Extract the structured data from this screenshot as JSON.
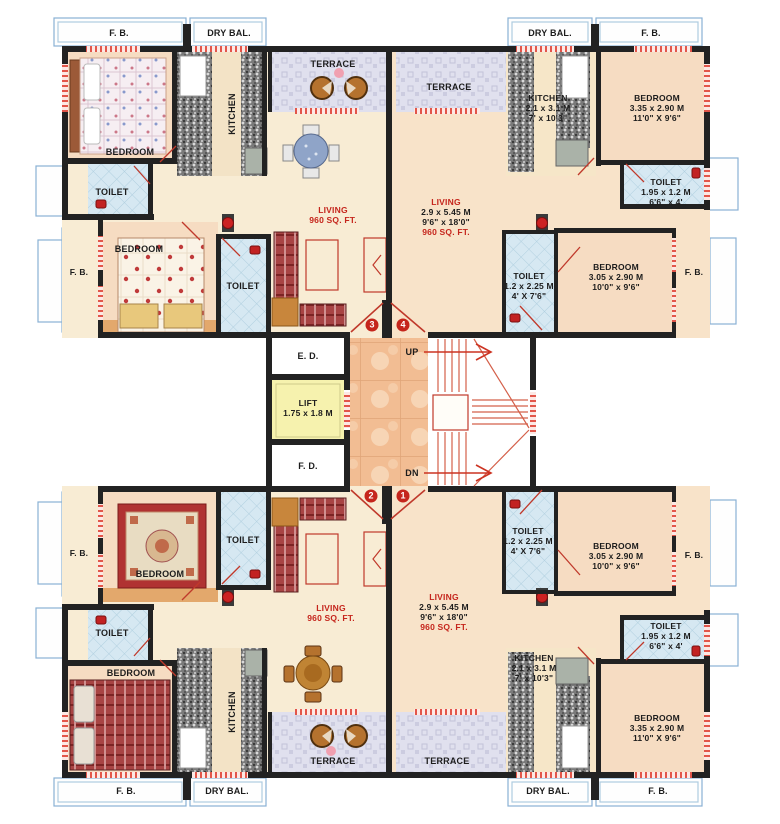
{
  "core": {
    "ed": "E. D.",
    "lift": "LIFT",
    "lift_dim": "1.75 x 1.8 M",
    "fd": "F. D.",
    "up": "UP",
    "dn": "DN"
  },
  "flats": {
    "top_left": {
      "number": "3",
      "fb_top": "F. B.",
      "dry_bal": "DRY BAL.",
      "terrace": "TERRACE",
      "kitchen": "KITCHEN",
      "bedroom1": "BEDROOM",
      "toilet1": "TOILET",
      "bedroom2": "BEDROOM",
      "fb_left": "F. B.",
      "toilet2": "TOILET",
      "living": "LIVING",
      "living_area": "960 SQ. FT."
    },
    "top_right": {
      "number": "4",
      "dry_bal": "DRY BAL.",
      "fb_top": "F. B.",
      "terrace": "TERRACE",
      "kitchen": {
        "name": "KITCHEN",
        "m": "2.1 x 3.1 M",
        "ft": "7' x 10'3\""
      },
      "bedroom1": {
        "name": "BEDROOM",
        "m": "3.35 x 2.90 M",
        "ft": "11'0\" X 9'6\""
      },
      "toilet1": {
        "name": "TOILET",
        "m": "1.95 x 1.2 M",
        "ft": "6'6\" x 4'"
      },
      "living": {
        "name": "LIVING",
        "m": "2.9 x 5.45 M",
        "ft": "9'6\" x 18'0\"",
        "area": "960 SQ. FT."
      },
      "toilet2": {
        "name": "TOILET",
        "m": "1.2 x 2.25 M",
        "ft": "4' X 7'6\""
      },
      "bedroom2": {
        "name": "BEDROOM",
        "m": "3.05 x 2.90 M",
        "ft": "10'0\" x 9'6\""
      },
      "fb_right": "F. B."
    },
    "bottom_left": {
      "number": "2",
      "fb_left": "F. B.",
      "toilet2": "TOILET",
      "bedroom1": "BEDROOM",
      "living": "LIVING",
      "living_area": "960 SQ. FT.",
      "toilet1": "TOILET",
      "bedroom2": "BEDROOM",
      "kitchen": "KITCHEN",
      "terrace": "TERRACE",
      "fb_bottom": "F. B.",
      "dry_bal": "DRY BAL."
    },
    "bottom_right": {
      "number": "1",
      "toilet2": {
        "name": "TOILET",
        "m": "1.2 x 2.25 M",
        "ft": "4' X 7'6\""
      },
      "bedroom2": {
        "name": "BEDROOM",
        "m": "3.05 x 2.90 M",
        "ft": "10'0\" x 9'6\""
      },
      "fb_right": "F. B.",
      "living": {
        "name": "LIVING",
        "m": "2.9 x 5.45 M",
        "ft": "9'6\" x 18'0\"",
        "area": "960 SQ. FT."
      },
      "toilet1": {
        "name": "TOILET",
        "m": "1.95 x 1.2 M",
        "ft": "6'6\" x 4'"
      },
      "kitchen": {
        "name": "KITCHEN",
        "m": "2.1 x 3.1 M",
        "ft": "7' x 10'3\""
      },
      "bedroom1": {
        "name": "BEDROOM",
        "m": "3.35 x 2.90 M",
        "ft": "11'0\" X 9'6\""
      },
      "terrace": "TERRACE",
      "dry_bal": "DRY BAL.",
      "fb_bottom": "F. B."
    }
  },
  "colors": {
    "wall": "#222222",
    "door_red": "#c0392b",
    "label_red": "#c5251c",
    "toilet_tile": "#d6e8f2",
    "terrace": "#e0e0ee",
    "lobby": "#f2bd93",
    "lift": "#f6f2ae",
    "floor_cream": "#f8ecd4",
    "floor_peach": "#f6dcc2",
    "balcony_outline": "#8ab1d4"
  }
}
